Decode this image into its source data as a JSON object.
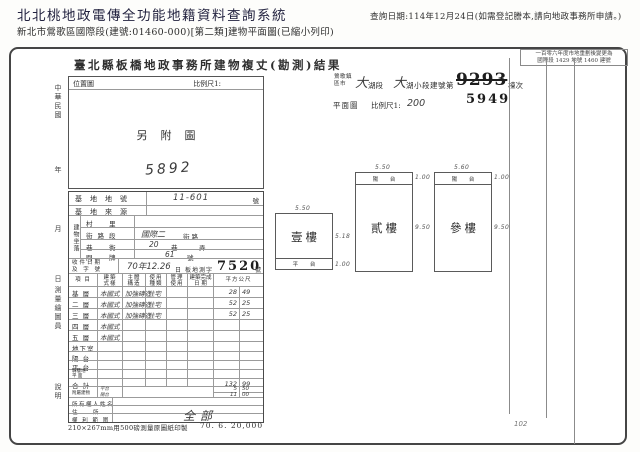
{
  "header": {
    "title": "北北桃地政電傳全功能地籍資料查詢系統",
    "subtitle": "新北市鶯歌區國際段(建號:01460-000)[第二類]建物平面圖(已縮小列印)",
    "query_date": "查詢日期:114年12月24日(如需登記謄本,請向地政事務所申請。)"
  },
  "doc": {
    "title": "臺北縣板橋地政事務所建物複丈(勘測)結果",
    "remark_box": {
      "line1": "一百零六年度市地重劃後變更為",
      "line2": "國際段 1429 地號 1460 建號"
    },
    "jurisdiction": {
      "town_line1": "鶯歌鎮",
      "town_line2": "區市",
      "hw_big1": "大",
      "seg1": "湖段",
      "hw_big2": "大",
      "seg2": "湖小段建號第",
      "old_building_no": "9293",
      "suffix": "棟次",
      "new_building_no": "5949"
    },
    "plan": {
      "label": "平面圖",
      "scale_label": "比例尺1:",
      "scale_value": "200"
    },
    "location_box": {
      "label": "位置圖",
      "scale_label": "比例尺1:",
      "content": "另附圖",
      "hw_number": "5892"
    },
    "margin_labels": [
      "中華民國",
      "年",
      "月",
      "日",
      "測量繪圖員",
      "說明"
    ],
    "buildings": [
      {
        "name": "壹樓",
        "top_dim": "5.50",
        "main_dim": "5.18",
        "strip_dim": "1.00",
        "strip_label": "平 台"
      },
      {
        "name": "貳樓",
        "top_dim": "5.50",
        "main_dim": "9.50",
        "strip_dim": "1.00",
        "strip_label": "陽 台"
      },
      {
        "name": "參樓",
        "top_dim": "5.60",
        "main_dim": "9.50",
        "strip_dim": "1.00",
        "strip_label": "陽 台"
      }
    ],
    "corner_note": "102",
    "site": {
      "rows": [
        {
          "label": "基地地號",
          "hw": "11-601",
          "unit": "號"
        },
        {
          "label": "基地來源",
          "hw": "",
          "unit": ""
        }
      ],
      "group_label": "建物坐落",
      "address_rows": [
        {
          "label": "村　里",
          "hw": "",
          "unit": "",
          "unit2": ""
        },
        {
          "label": "街路段",
          "hw": "國際二",
          "unit": "街路",
          "unit2": ""
        },
        {
          "label": "巷　衖",
          "hw": "20",
          "unit": "巷",
          "unit2": "弄"
        },
        {
          "label": "門　牌",
          "hw": "61",
          "unit": "號",
          "unit2": ""
        }
      ],
      "receipt": {
        "label_line1": "收件日期",
        "label_line2": "及 字 號",
        "hw_date": "70年12.26",
        "printed_day": "日",
        "printed_word": "板地測字",
        "stamp": "7520",
        "unit": "號"
      }
    },
    "floors": {
      "headers": [
        [
          "項 目"
        ],
        [
          "建築",
          "式樣"
        ],
        [
          "主體",
          "構造"
        ],
        [
          "使用",
          "種類"
        ],
        [
          "管理",
          "使用"
        ],
        [
          "建築完成",
          "日 期"
        ],
        [
          "平方公尺"
        ]
      ],
      "rows": [
        {
          "label": "基 層",
          "style": "本國式",
          "structure": "加強磚造",
          "use": "住宅",
          "mgmt": "",
          "date": "",
          "area_int": "28",
          "area_dec": "49"
        },
        {
          "label": "二 層",
          "style": "本國式",
          "structure": "加強磚造",
          "use": "住宅",
          "mgmt": "",
          "date": "",
          "area_int": "52",
          "area_dec": "25"
        },
        {
          "label": "三 層",
          "style": "本國式",
          "structure": "加強磚造",
          "use": "住宅",
          "mgmt": "",
          "date": "",
          "area_int": "52",
          "area_dec": "25"
        },
        {
          "label": "四 層",
          "style": "本國式",
          "structure": "",
          "use": "",
          "mgmt": "",
          "date": "",
          "area_int": "",
          "area_dec": ""
        },
        {
          "label": "五 層",
          "style": "本國式",
          "structure": "",
          "use": "",
          "mgmt": "",
          "date": "",
          "area_int": "",
          "area_dec": ""
        },
        {
          "label": "地下室",
          "style": "",
          "structure": "",
          "use": "",
          "mgmt": "",
          "date": "",
          "area_int": "",
          "area_dec": ""
        },
        {
          "label": "陽 台",
          "style": "",
          "structure": "",
          "use": "",
          "mgmt": "",
          "date": "",
          "area_int": "",
          "area_dec": ""
        },
        {
          "label": "平 台",
          "style": "",
          "structure": "",
          "use": "",
          "mgmt": "",
          "date": "",
          "area_int": "",
          "area_dec": ""
        },
        {
          "label": "騎樓地",
          "label2": "平 面",
          "style": "",
          "structure": "",
          "use": "",
          "mgmt": "",
          "date": "",
          "area_int": "",
          "area_dec": ""
        },
        {
          "label": "合 計",
          "style": "",
          "structure": "",
          "use": "",
          "mgmt": "",
          "date": "",
          "area_int": "132",
          "area_dec": "99"
        },
        {
          "label": "附屬建物",
          "attachments": [
            {
              "name": "平台",
              "area_int": "5",
              "area_dec": "50"
            },
            {
              "name": "陽台",
              "area_int": "11",
              "area_dec": "00"
            }
          ]
        },
        {
          "label": "所有權人姓名",
          "merged": true
        },
        {
          "label": "住　　所",
          "merged": true
        },
        {
          "label": "權 利 範 圍",
          "merged": true,
          "hw_value": "全部"
        }
      ]
    },
    "footer": {
      "left": "210×267mm用500磅測量原圖紙印製",
      "right": "70. 6. 20,000"
    }
  }
}
